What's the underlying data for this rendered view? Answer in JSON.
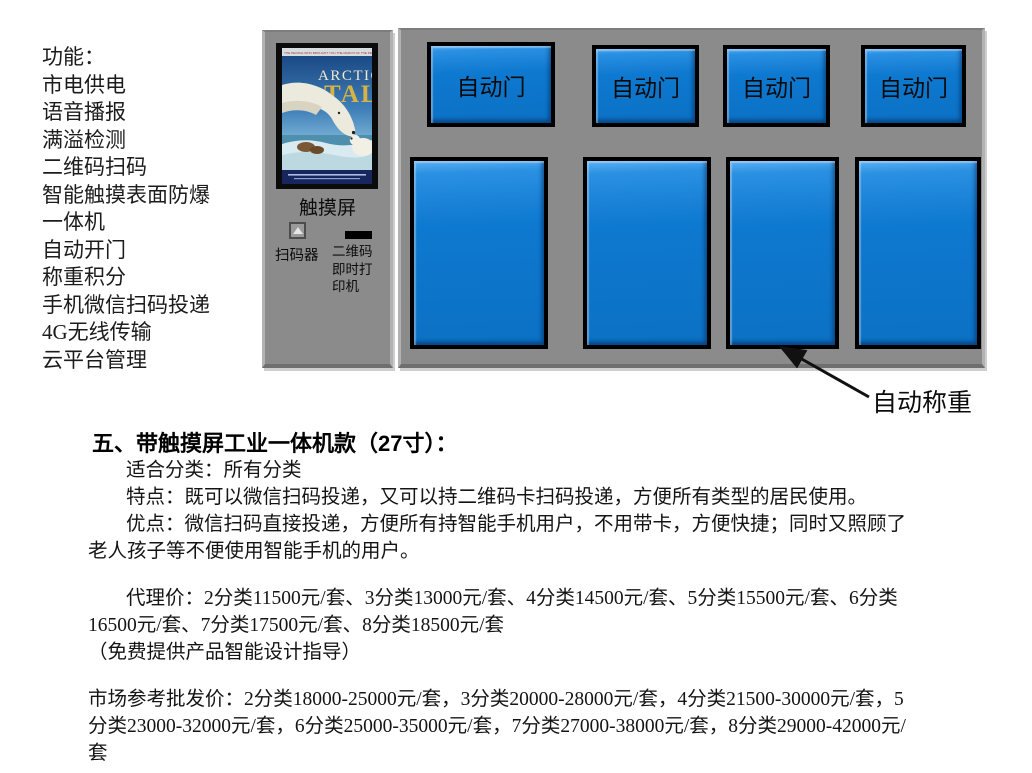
{
  "features": {
    "title": "功能：",
    "items": [
      "市电供电",
      "语音播报",
      "满溢检测",
      "二维码扫码",
      "智能触摸表面防爆",
      "一体机",
      "自动开门",
      "称重积分",
      "手机微信扫码投递",
      "4G无线传输",
      "云平台管理"
    ]
  },
  "machine": {
    "poster": {
      "tagline": "THE PEOPLE WHO BROUGHT YOU THE MARCH OF THE PENGUINS",
      "title_line1": "ARCTIC",
      "title_line2": "TALE"
    },
    "touchscreen_label": "触摸屏",
    "scanner_label": "扫码器",
    "printer_label": "二维码\n即时打\n印机",
    "door_buttons": [
      "自动门",
      "自动门",
      "自动门",
      "自动门"
    ],
    "weighing_label": "自动称重"
  },
  "description": {
    "heading": "五、带触摸屏工业一体机款（27寸）：",
    "lines": [
      "适合分类：所有分类",
      "特点：既可以微信扫码投递，又可以持二维码卡扫码投递，方便所有类型的居民使用。",
      "优点：微信扫码直接投递，方便所有持智能手机用户，不用带卡，方便快捷；同时又照顾了",
      "老人孩子等不便使用智能手机的用户。",
      "",
      "代理价：2分类11500元/套、3分类13000元/套、4分类14500元/套、5分类15500元/套、6分类",
      "16500元/套、7分类17500元/套、8分类18500元/套",
      "（免费提供产品智能设计指导）",
      "",
      "市场参考批发价：2分类18000-25000元/套，3分类20000-28000元/套，4分类21500-30000元/套，5",
      "分类23000-32000元/套，6分类25000-35000元/套，7分类27000-38000元/套，8分类29000-42000元/",
      "套"
    ]
  },
  "colors": {
    "panel_gray": "#8b8b8b",
    "bin_blue": "#0e79d0",
    "bevel_light_blue": "#5db0f2",
    "border_black": "#000000"
  }
}
